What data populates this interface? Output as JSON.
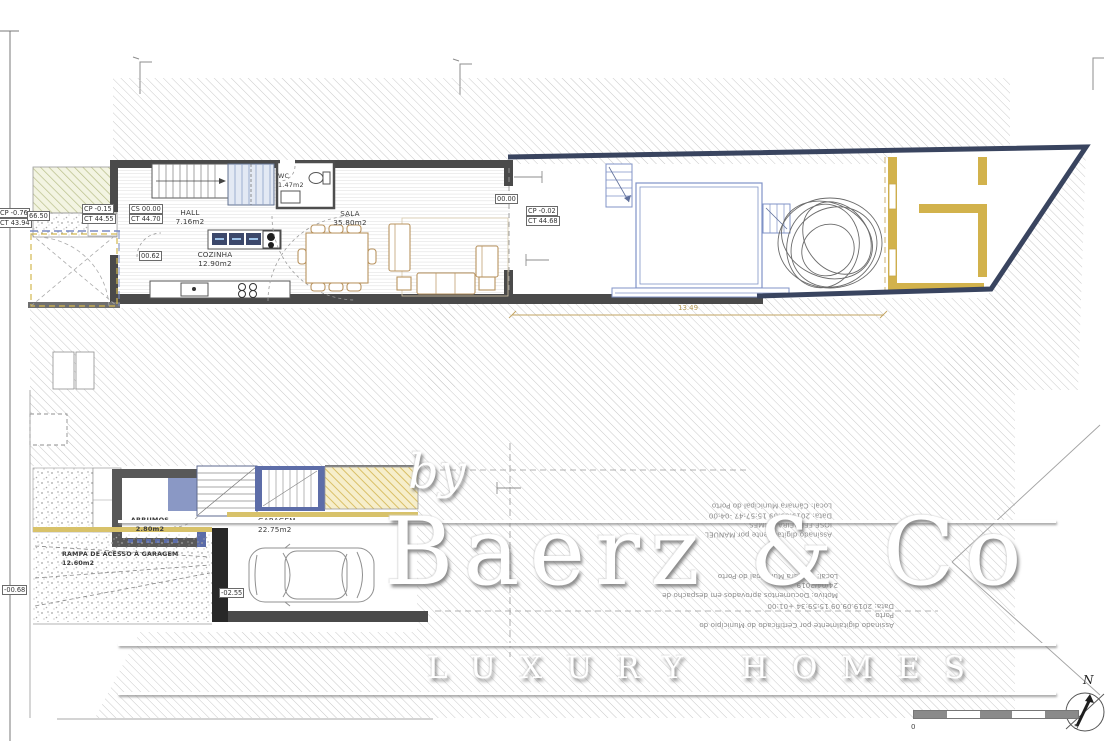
{
  "upper": {
    "levels": {
      "cp1": "CP -0.76",
      "ct1": "CT 43.94",
      "mark": "66.50",
      "cp2": "CP -0.15",
      "ct2": "CT 44.55",
      "cs": "CS 00.00",
      "ct3": "CT 44.70",
      "step": "00.62",
      "zero": "00.00",
      "cp3": "CP -0.02",
      "ct4": "CT 44.68"
    },
    "rooms": {
      "hall_name": "HALL",
      "hall_area": "7.16m2",
      "wc_name": "WC",
      "wc_area": "1.47m2",
      "sala_name": "SALA",
      "sala_area": "35.80m2",
      "cozinha_name": "COZINHA",
      "cozinha_area": "12.90m2"
    },
    "dim": "13.49"
  },
  "lower": {
    "rooms": {
      "arrumos_name": "ARRUMOS",
      "arrumos_area": "2.80m2",
      "garagem_name": "GARAGEM",
      "garagem_area": "22.75m2",
      "rampa_name": "RAMPA DE ACESSO À GARAGEM",
      "rampa_area": "12.60m2"
    },
    "levels": {
      "ramp": "-00.68",
      "floor": "-02.55"
    }
  },
  "stamps": {
    "b1": [
      "Assinado digitalmente por MANUEL",
      "JOSE FERREIRA GOMES",
      "Data: 2019.09.09 15:57:47 -04:00",
      "Local: Câmara Municipal do Porto"
    ],
    "b2": [
      "Motivo: Documentos aprovados em despacho de",
      "24/04/2019",
      "Local: Câmara Municipal do Porto"
    ],
    "b3": [
      "Assinado digitalmente por Certificado do Município do",
      "Porto",
      "Data: 2019.09.09 15:59:34 +01:00"
    ]
  },
  "watermark": {
    "by": "by",
    "brand": "Baerz & Co",
    "tagline": "LUXURY HOMES"
  },
  "scalebar": {
    "start": "0",
    "end": "5"
  },
  "compass": {
    "label": "N"
  }
}
